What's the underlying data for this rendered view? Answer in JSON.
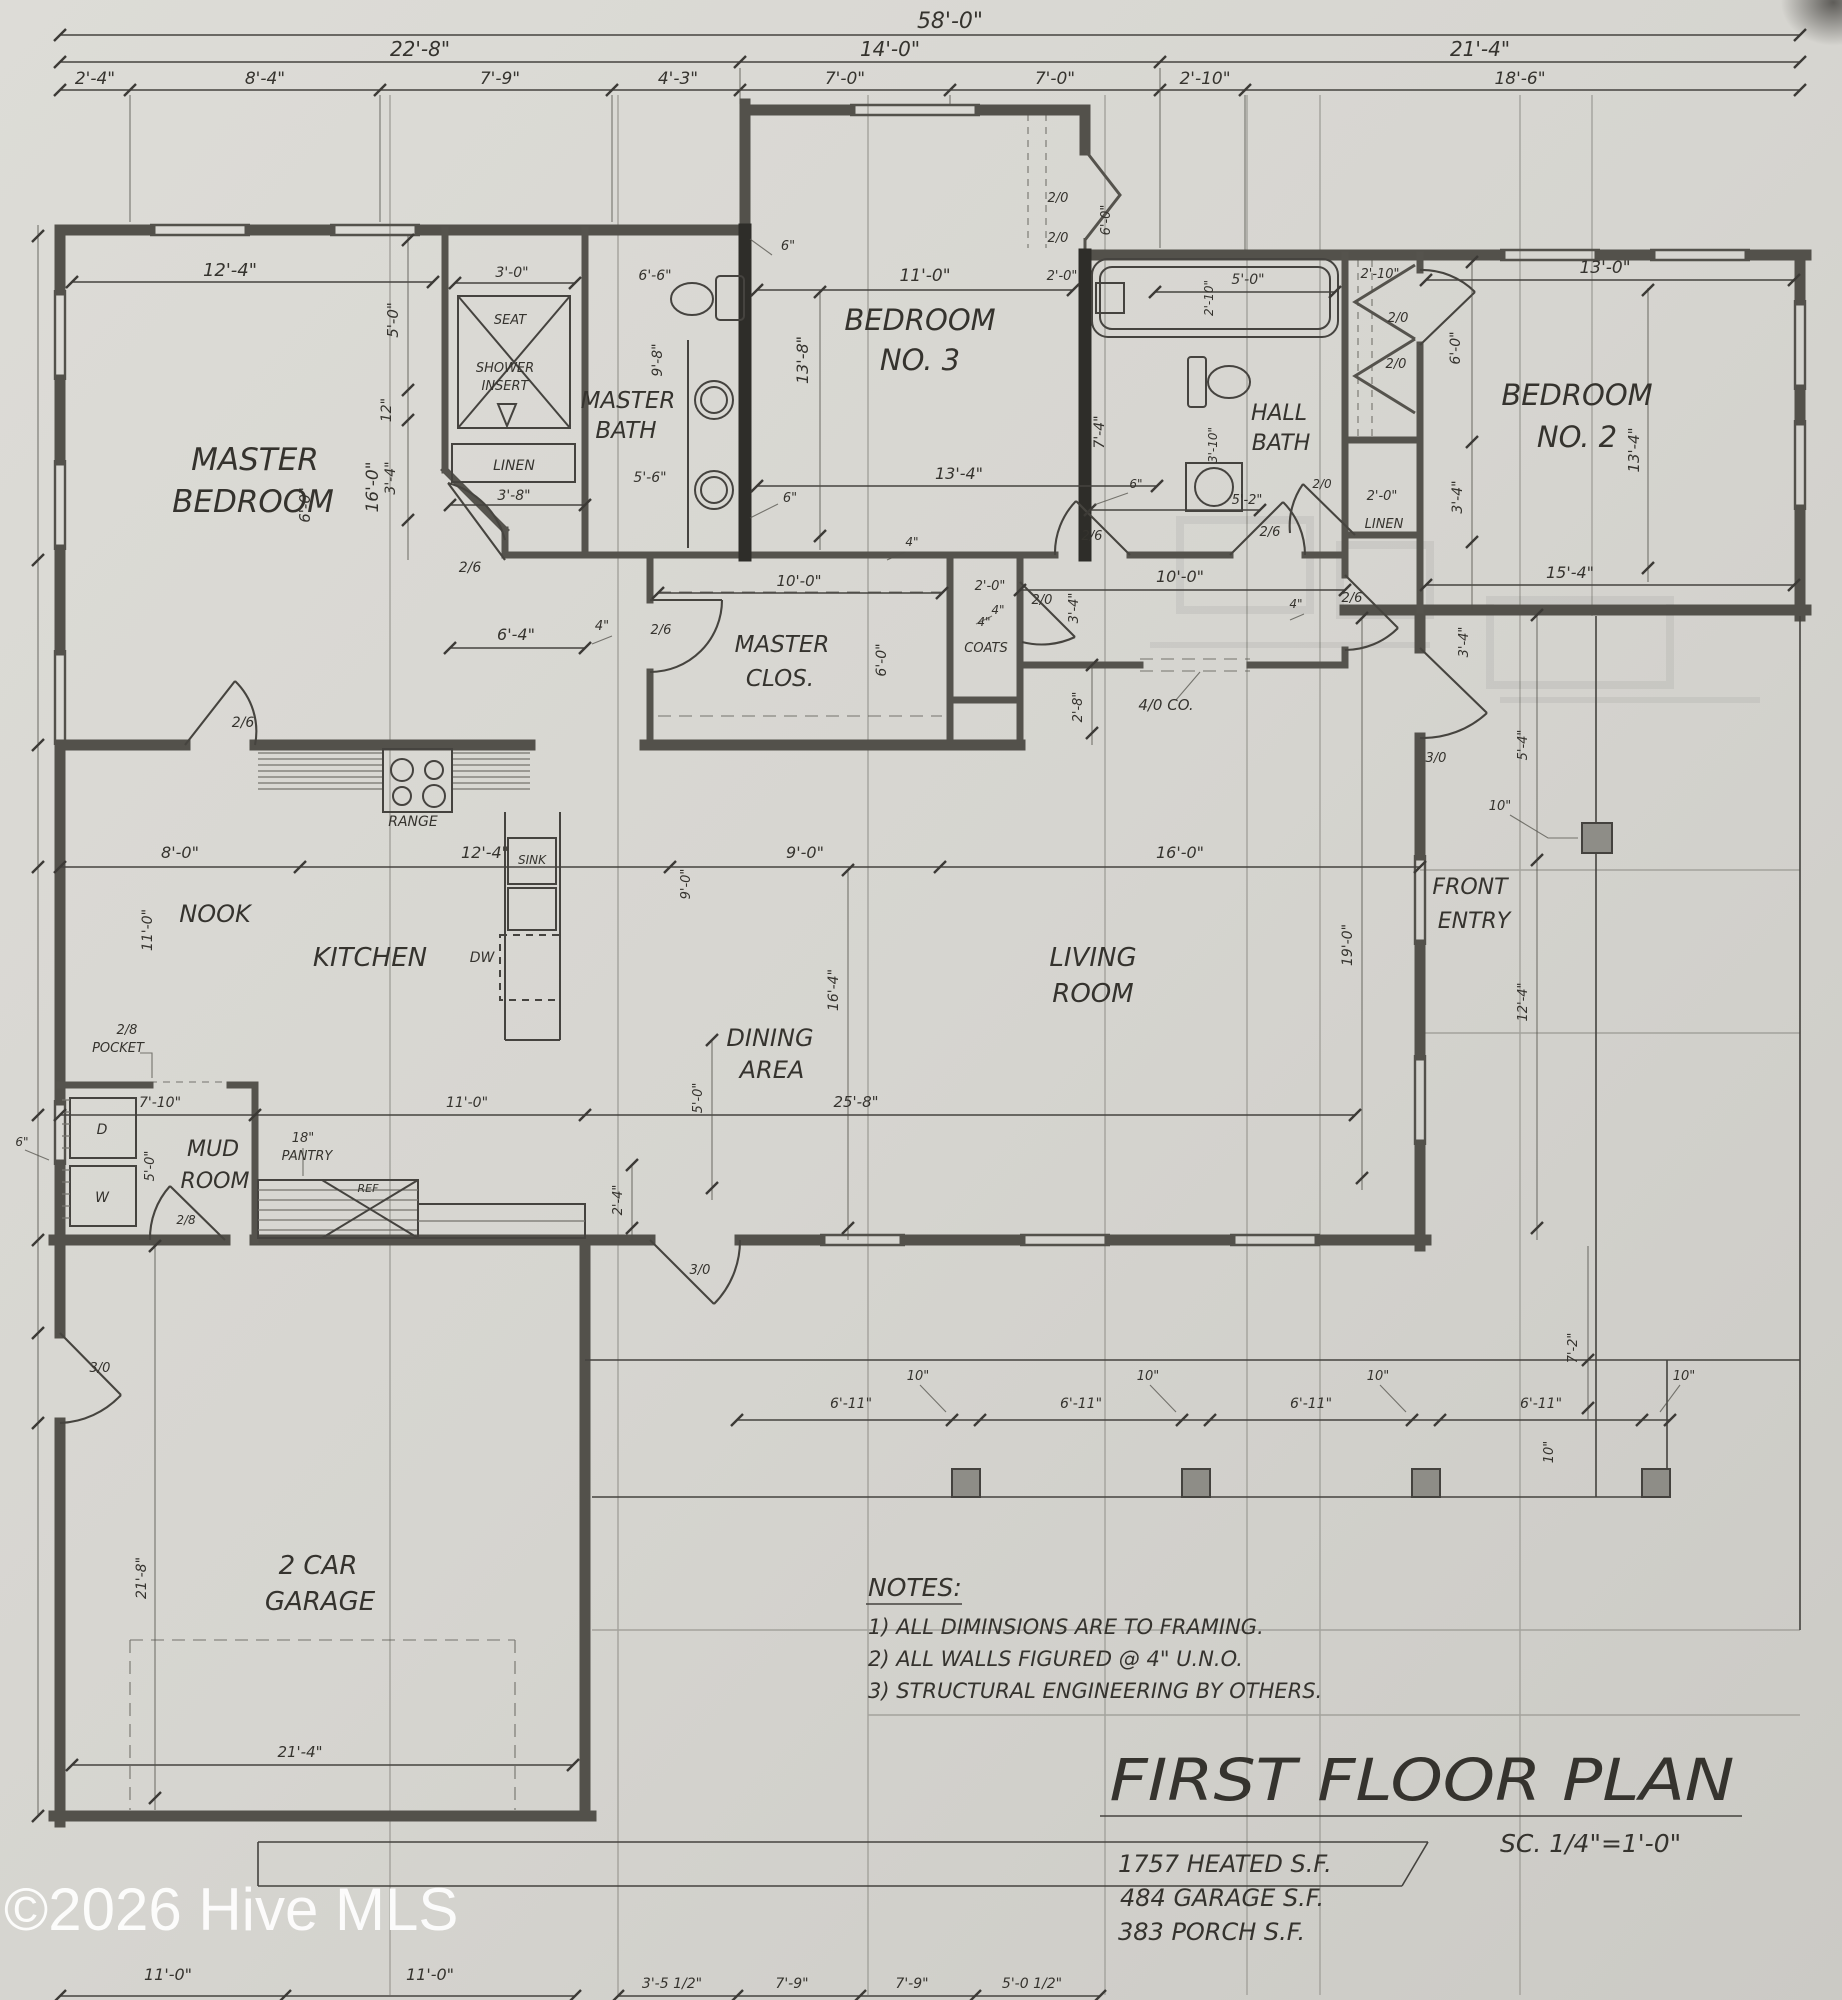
{
  "watermark": "©2026 Hive MLS",
  "title_block": {
    "heading": "FIRST FLOOR PLAN",
    "scale": "SC. 1/4\"=1'-0\"",
    "areas": [
      "1757 HEATED S.F.",
      "484 GARAGE S.F.",
      "383 PORCH S.F."
    ]
  },
  "notes": {
    "heading": "NOTES:",
    "items": [
      "1) ALL DIMINSIONS ARE TO FRAMING.",
      "2) ALL WALLS FIGURED @ 4\" U.N.O.",
      "3) STRUCTURAL ENGINEERING BY OTHERS."
    ]
  },
  "rooms": {
    "master_bedroom": [
      "MASTER",
      "BEDROOM"
    ],
    "master_bath": [
      "MASTER",
      "BATH"
    ],
    "bedroom3": [
      "BEDROOM",
      "NO. 3"
    ],
    "hall_bath": [
      "HALL",
      "BATH"
    ],
    "bedroom2": [
      "BEDROOM",
      "NO. 2"
    ],
    "master_closet": [
      "MASTER",
      "CLOS."
    ],
    "nook": "NOOK",
    "kitchen": "KITCHEN",
    "dining": [
      "DINING",
      "AREA"
    ],
    "living": [
      "LIVING",
      "ROOM"
    ],
    "front_entry": [
      "FRONT",
      "ENTRY"
    ],
    "mud_room": [
      "MUD",
      "ROOM"
    ],
    "garage": [
      "2 CAR",
      "GARAGE"
    ],
    "pantry": "PANTRY",
    "coats": "COATS",
    "linen": "LINEN",
    "seat": "SEAT",
    "shower": [
      "SHOWER",
      "INSERT"
    ]
  },
  "fixtures": {
    "range": "RANGE",
    "sink": "SINK",
    "dw": "DW",
    "ref": "REF",
    "washer": "W",
    "dryer": "D",
    "pocket": "POCKET"
  },
  "doors": {
    "nook": "2/6",
    "master": "2/6",
    "closet": "2/6",
    "bed3": "2/6",
    "hallbath": "2/6",
    "corridor_w": "2/0",
    "corridor_e": "2/6",
    "linen_hall": "2/0",
    "mud": "2/8",
    "pocket_size": "2/8",
    "rear": "3/0",
    "front": "3/0",
    "garage_side": "3/0",
    "bed3_closet": [
      "2/0",
      "2/0"
    ],
    "bed2_closet": [
      "2/0",
      "2/0"
    ],
    "cased": "4/0 CO."
  },
  "dims": {
    "overall": "58'-0\"",
    "row2": [
      "22'-8\"",
      "14'-0\"",
      "21'-4\""
    ],
    "row3": [
      "2'-4\"",
      "8'-4\"",
      "7'-9\"",
      "4'-3\"",
      "7'-0\"",
      "7'-0\"",
      "2'-10\"",
      "18'-6\""
    ],
    "master": {
      "w": "12'-4\"",
      "h": "16'-0\"",
      "a": "5'-0\"",
      "b": "12\"",
      "c": "3'-4\"",
      "d": "6'-0\"",
      "hall": "6'-4\"",
      "four": "4\""
    },
    "shower_w": "3'-0\"",
    "linen_w": "3'-8\"",
    "mbath": {
      "w": "6'-6\"",
      "l": "9'-8\"",
      "b": "5'-6\"",
      "six": "6\""
    },
    "bed3": {
      "w": "11'-0\"",
      "h": "13'-8\"",
      "b": "13'-4\"",
      "four": "4\"",
      "e": "7'-4\"",
      "cl_h": "6'-0\"",
      "cl_w": "2'-0\"",
      "six": "6\""
    },
    "hbath": {
      "tub": "5'-0\"",
      "tub_w": "2'-10\"",
      "vest": "2'-10\"",
      "wc": "3'-10\"",
      "b": "5'-2\"",
      "six": "6\""
    },
    "linen2_w": "2'-0\"",
    "bed2": {
      "w": "13'-0\"",
      "cl": "6'-0\"",
      "c": "3'-4\"",
      "h": "13'-4\"",
      "b": "15'-4\""
    },
    "clos": {
      "w": "10'-0\"",
      "d": "6'-0\""
    },
    "coats": {
      "w": "2'-0\"",
      "four": "4\""
    },
    "corr": {
      "w": "10'-0\"",
      "l4": "4\"",
      "r4": "4\"",
      "c34": "3'-4\"",
      "c34b": "3'-4\"",
      "c28": "2'-8\""
    },
    "band": [
      "8'-0\"",
      "12'-4\"",
      "9'-0\"",
      "16'-0\""
    ],
    "nook_h": "11'-0\"",
    "dining": {
      "h": "16'-4\"",
      "v9": "9'-0\"",
      "v5": "5'-0\"",
      "v24": "2'-4\""
    },
    "living_h": "19'-0\"",
    "band2": [
      "7'-10\"",
      "11'-0\"",
      "25'-8\""
    ],
    "mud": {
      "w": "5'-0\"",
      "six": "6\"",
      "pantry": "18\""
    },
    "garage": {
      "h": "21'-8\"",
      "door": "21'-4\""
    },
    "entry": {
      "v54": "5'-4\"",
      "v124": "12'-4\"",
      "ten": "10\""
    },
    "porch": {
      "bay": "6'-11\"",
      "ten": "10\"",
      "v72": "7'-2\""
    },
    "bottom": [
      "11'-0\"",
      "11'-0\"",
      "3'-5 1/2\"",
      "7'-9\"",
      "7'-9\"",
      "5'-0 1/2\""
    ]
  }
}
